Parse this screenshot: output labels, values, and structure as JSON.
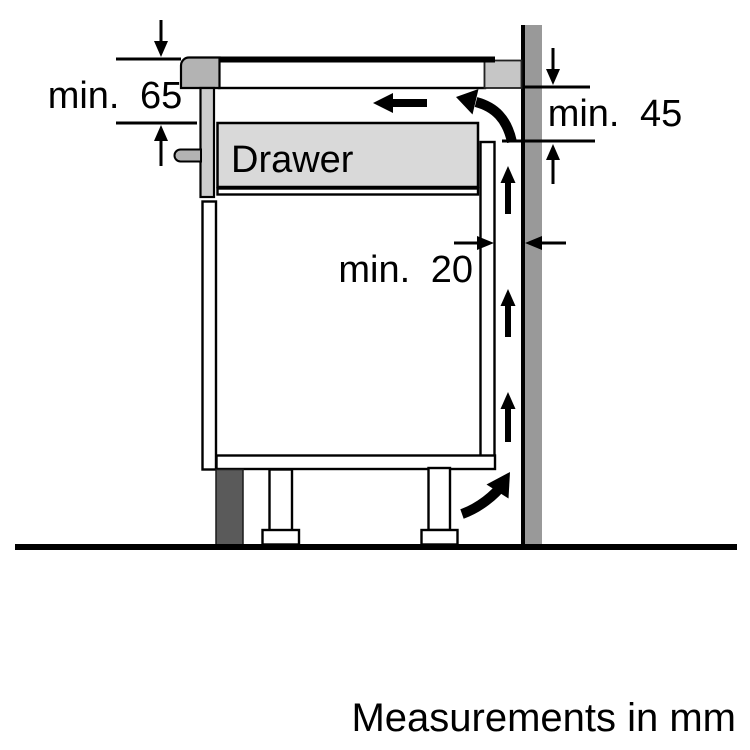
{
  "diagram": {
    "labels": {
      "clearance_top": "min. 65",
      "clearance_side": "min. 45",
      "clearance_back": "min. 20",
      "drawer": "Drawer"
    },
    "footer": "Measurements in mm",
    "colors": {
      "background": "#ffffff",
      "line": "#000000",
      "wall": "#999999",
      "worktop_back": "#c6c6c6",
      "hob_trim": "#b3b3b3",
      "side_strip": "#cccccc",
      "bracket": "#b3b3b3",
      "drawer_fill": "#d9d9d9",
      "plinth": "#5a5a5a"
    }
  }
}
